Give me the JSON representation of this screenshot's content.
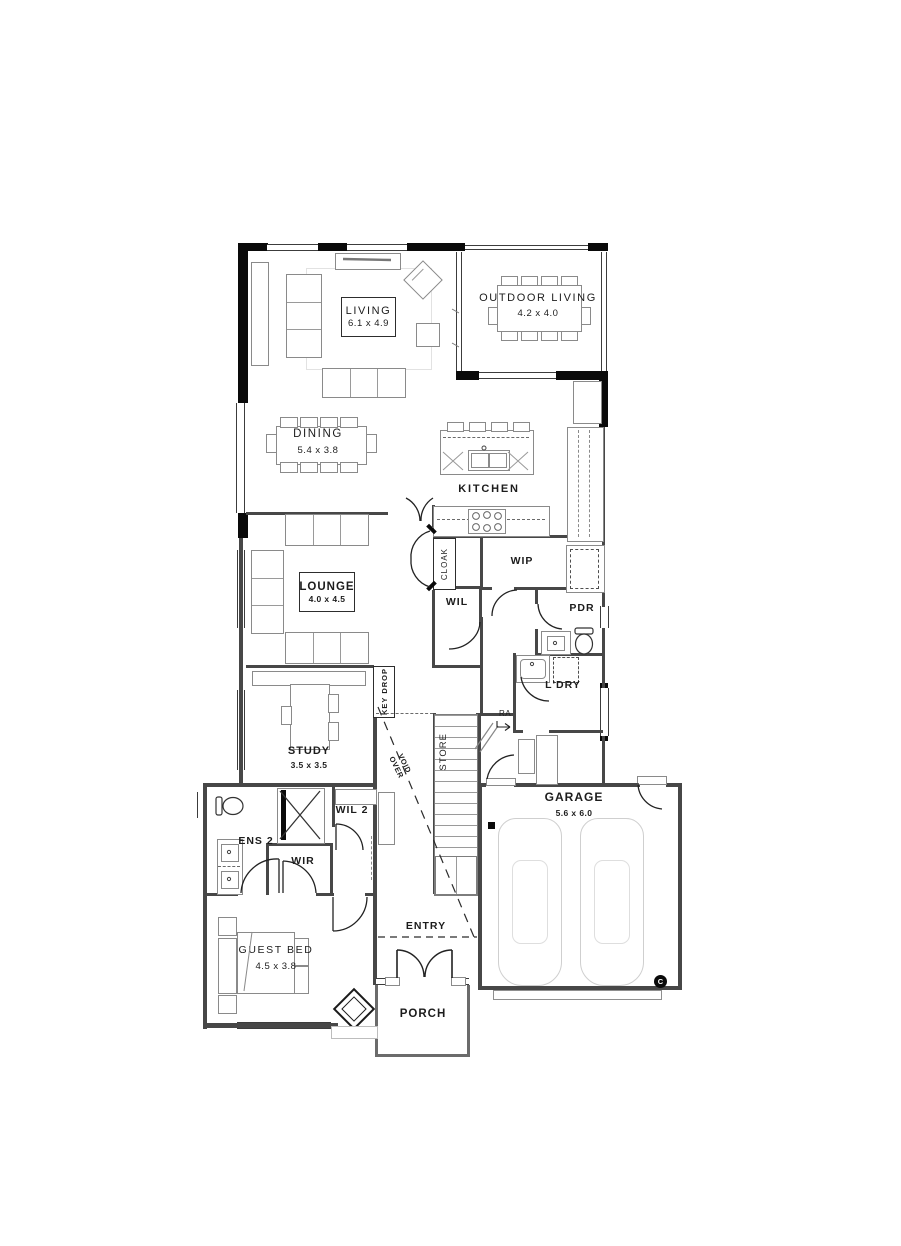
{
  "title": "single-storey house floor plan",
  "colors": {
    "wall": "#0a0a0a",
    "interior_wall": "#474747",
    "furniture_line": "#8a8a8a",
    "light_line": "#cacaca",
    "text": "#1c1c1c"
  },
  "rooms": {
    "living": {
      "label": "LIVING",
      "dims": "6.1 x 4.9"
    },
    "outdoor_living": {
      "label": "OUTDOOR LIVING",
      "dims": "4.2 x 4.0"
    },
    "dining": {
      "label": "DINING",
      "dims": "5.4 x 3.8"
    },
    "kitchen": {
      "label": "KITCHEN"
    },
    "lounge": {
      "label": "LOUNGE",
      "dims": "4.0 x 4.5"
    },
    "study": {
      "label": "STUDY",
      "dims": "3.5 x 3.5"
    },
    "guest_bed": {
      "label": "GUEST BED",
      "dims": "4.5 x 3.8"
    },
    "garage": {
      "label": "GARAGE",
      "dims": "5.6 x 6.0"
    },
    "porch": {
      "label": "PORCH"
    },
    "entry": {
      "label": "ENTRY"
    }
  },
  "areas": {
    "ens2": {
      "label": "ENS 2"
    },
    "wir": {
      "label": "WIR"
    },
    "wil2": {
      "label": "WIL 2"
    },
    "wil": {
      "label": "WIL"
    },
    "wip": {
      "label": "WIP"
    },
    "pdr": {
      "label": "PDR"
    },
    "ldry": {
      "label": "L'DRY"
    },
    "cloak": {
      "label": "CLOAK"
    },
    "store": {
      "label": "STORE"
    },
    "key_drop": {
      "label": "KEY DROP"
    },
    "void_over": {
      "label": "VOID OVER"
    },
    "ra": {
      "label": "RA"
    },
    "column_marker": {
      "label": "C"
    }
  }
}
